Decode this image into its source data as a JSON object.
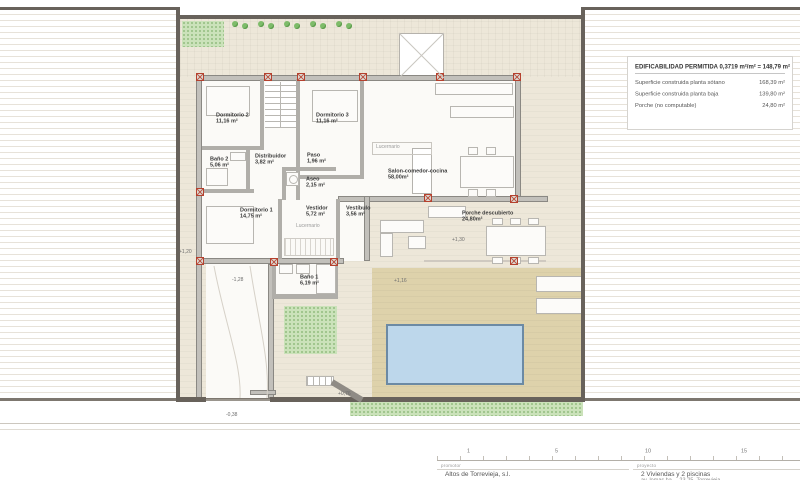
{
  "drawing": {
    "info_box": {
      "title": "EDIFICABILIDAD PERMITIDA 0,3719 m²/m² = 148,79 m²",
      "rows": [
        {
          "label": "Superficie construida planta sótano",
          "value": "168,39 m²"
        },
        {
          "label": "Superficie construida planta baja",
          "value": "139,80 m²"
        },
        {
          "label": "Porche (no computable)",
          "value": "24,80 m²"
        }
      ]
    },
    "rooms": {
      "dormitorio2": {
        "name": "Dormitorio 2",
        "area": "11,16 m²"
      },
      "dormitorio3": {
        "name": "Dormitorio 3",
        "area": "11,16 m²"
      },
      "bano2": {
        "name": "Baño 2",
        "area": "5,06 m²"
      },
      "distribuidor": {
        "name": "Distribuidor",
        "area": "3,82 m²"
      },
      "paso": {
        "name": "Paso",
        "area": "1,96 m²"
      },
      "aseo": {
        "name": "Aseo",
        "area": "2,15 m²"
      },
      "salon": {
        "name": "Salon-comedor-cocina",
        "area": "58,00m²"
      },
      "dormitorio1": {
        "name": "Dormitorio 1",
        "area": "14,75 m²"
      },
      "vestidor": {
        "name": "Vestidor",
        "area": "5,72 m²"
      },
      "vestibulo": {
        "name": "Vestíbulo",
        "area": "3,56 m²"
      },
      "bano1": {
        "name": "Baño 1",
        "area": "6,19 m²"
      },
      "porche": {
        "name": "Porche descubierto",
        "area": "24,80m²"
      }
    },
    "annotations": {
      "lucernario": "Lucernario",
      "levels": {
        "left": "+1,20",
        "garage": "-1,28",
        "porch": "+1,30",
        "pool_deck": "+1,16",
        "steps": "+0,76",
        "entrance": "-0,38"
      }
    },
    "colors": {
      "ground": "#ede7d9",
      "deck": "#ded2ab",
      "pool": "#bdd7eb",
      "grass": "#cbe2ba",
      "wall": "#c2c0bb",
      "boundary": "#68625b",
      "column_red": "#b5412e"
    }
  },
  "title_block": {
    "scale_ticks": [
      "1",
      "5",
      "10",
      "15"
    ],
    "promoter_label": "promotor",
    "promoter": "Altos de Torrevieja, s.l.",
    "project_label": "proyecto",
    "project": "2 Viviendas y 2 piscinas",
    "address": "av. lomas ba..., 23-25, Torrevieja"
  }
}
